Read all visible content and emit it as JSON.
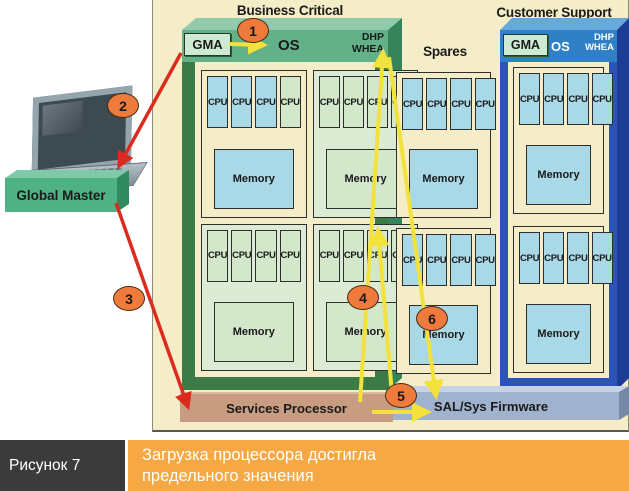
{
  "titles": {
    "business_critical": "Business Critical",
    "customer_support": "Customer Support",
    "spares": "Spares"
  },
  "labels": {
    "gma": "GMA",
    "os": "OS",
    "dhp_line1": "DHP",
    "dhp_line2": "WHEA",
    "cpu": "CPU",
    "memory": "Memory",
    "global_master": "Global Master",
    "services_processor": "Services Processor",
    "sal_firmware": "SAL/Sys Firmware"
  },
  "steps": {
    "s1": "1",
    "s2": "2",
    "s3": "3",
    "s4": "4",
    "s5": "5",
    "s6": "6"
  },
  "cell_groups": {
    "bc_tl": {
      "bg": "cream",
      "cpus": [
        "blue",
        "blue",
        "blue",
        "green"
      ],
      "memory": "blue"
    },
    "bc_tr": {
      "bg": "green",
      "cpus": [
        "green",
        "green",
        "green",
        "green"
      ],
      "memory": "green"
    },
    "bc_bl": {
      "bg": "green",
      "cpus": [
        "green",
        "green",
        "green",
        "green"
      ],
      "memory": "green"
    },
    "bc_br": {
      "bg": "green",
      "cpus": [
        "green",
        "green",
        "green",
        "green"
      ],
      "memory": "green"
    },
    "sp_t": {
      "bg": "cream",
      "cpus": [
        "blue",
        "blue",
        "blue",
        "blue"
      ],
      "memory": "blue"
    },
    "sp_b": {
      "bg": "cream",
      "cpus": [
        "blue",
        "blue",
        "blue",
        "blue"
      ],
      "memory": "blue"
    },
    "cs_t": {
      "bg": "cream",
      "cpus": [
        "blue",
        "blue",
        "blue",
        "blue"
      ],
      "memory": "blue"
    },
    "cs_b": {
      "bg": "cream",
      "cpus": [
        "blue",
        "blue",
        "blue",
        "blue"
      ],
      "memory": "blue"
    }
  },
  "icons": {
    "laptop": "laptop-icon"
  },
  "caption": {
    "figure": "Рисунок 7",
    "line1": "Загрузка процессора достигла",
    "line2": "предельного значения"
  },
  "colors": {
    "cream": "#F4EDC7",
    "partition_green": "#63B189",
    "partition_blue": "#2F80C4",
    "active_blue": "#A9D9E7",
    "services_tan": "#C89C80",
    "sal_gray": "#A0B3CE",
    "step_orange": "#EE7B3B",
    "caption_orange": "#F6A844",
    "caption_dark": "#3B3B3B",
    "arrow_red": "#DB2B1E",
    "arrow_yellow": "#F3E13C"
  }
}
